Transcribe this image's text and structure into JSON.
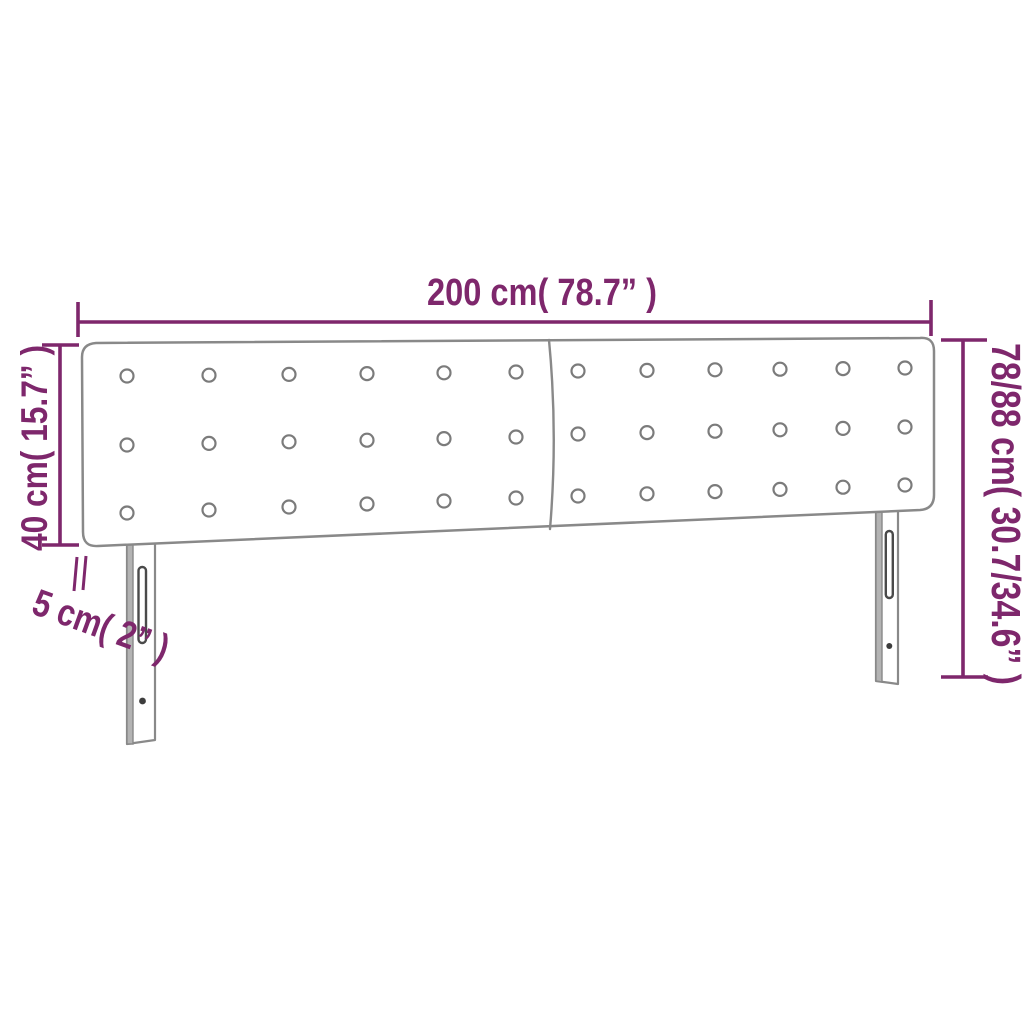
{
  "page": {
    "background": "#ffffff"
  },
  "diagram": {
    "type": "product-dimensions",
    "product": "upholstered headboard with two legs",
    "labels": {
      "width": "200 cm( 78.7” )",
      "height_left": "40 cm( 15.7” )",
      "thickness": "5 cm( 2” )",
      "height_right": "78/88 cm( 30.7/34.6” )"
    },
    "colors": {
      "dimension_accent": "#7E276C",
      "outline_gray": "#898989",
      "leg_shade_gray": "#B3B3B3",
      "hardware_dark": "#3D3D3D"
    },
    "button_grid": {
      "panels": 2,
      "rows": 3,
      "columns_per_panel": 6
    }
  }
}
